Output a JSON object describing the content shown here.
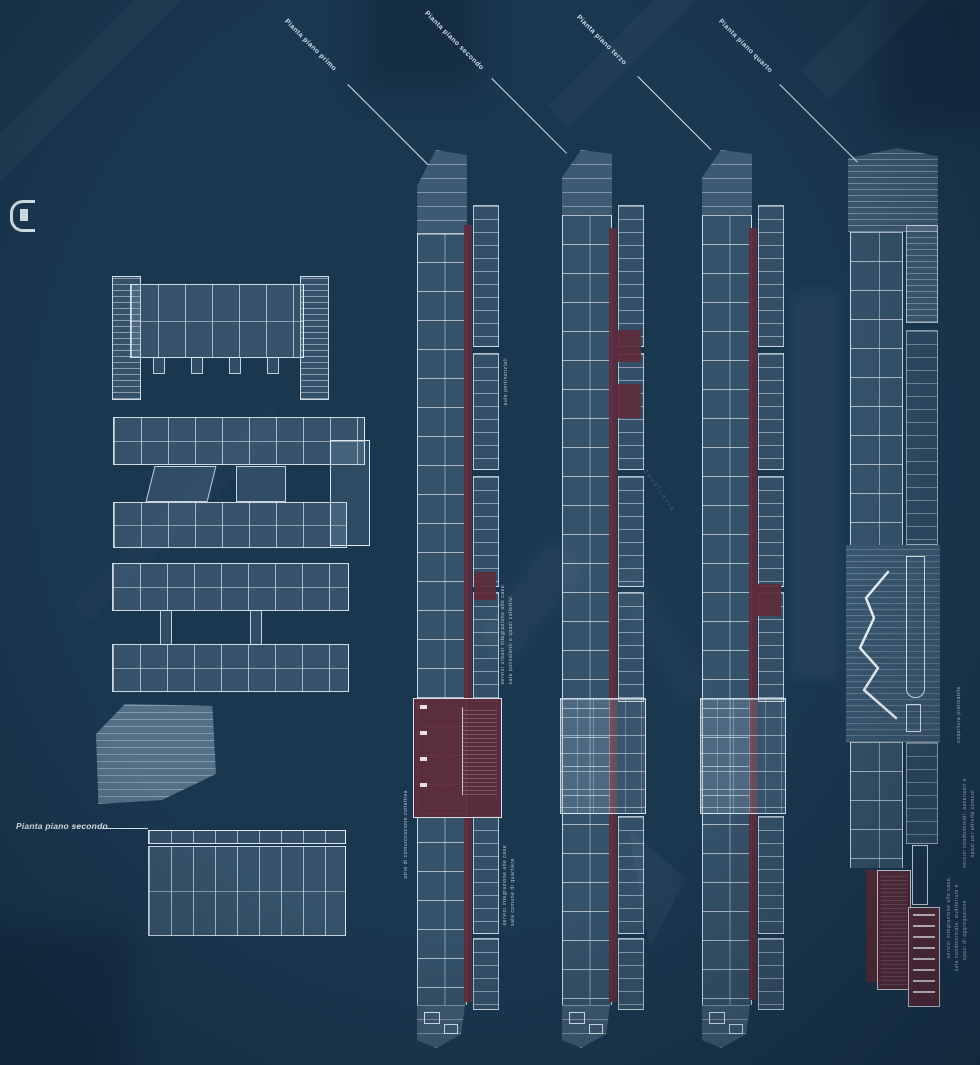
{
  "colors": {
    "background": "#1a3750",
    "plan_line": "#e8f1f7",
    "highlight_maroon": "#5d2c3c",
    "label_text": "#cddded"
  },
  "callouts": [
    {
      "label": "Pianta piano primo"
    },
    {
      "label": "Pianta piano secondo"
    },
    {
      "label": "Pianta piano terzo"
    },
    {
      "label": "Pianta piano quarto"
    }
  ],
  "left_callout": {
    "label": "Pianta piano secondo"
  },
  "annotations": [
    {
      "id": "plan1-upper",
      "lines": [
        "aule pertinenziali"
      ]
    },
    {
      "id": "plan1-mid",
      "lines": [
        "servizi urbani integrazione alle case:",
        "sale polivalenti e spazi collettivi"
      ]
    },
    {
      "id": "plan1-left",
      "lines": [
        "atrio di comunicazione collettiva"
      ]
    },
    {
      "id": "plan1-lower",
      "lines": [
        "servizi integrazione alle case:",
        "sala comune di quartiere"
      ]
    },
    {
      "id": "roof",
      "lines": [
        "copertura praticabile"
      ]
    },
    {
      "id": "plan4-mid",
      "lines": [
        "servizi condominiali: ascensori e",
        "spazi per attività comuni"
      ]
    },
    {
      "id": "plan4-lower",
      "lines": [
        "servizi integrazione alle case:",
        "sala condominiale, auditorium e",
        "spazi di aggregazione"
      ]
    }
  ],
  "background_text": {
    "label": "cavalcavia"
  }
}
